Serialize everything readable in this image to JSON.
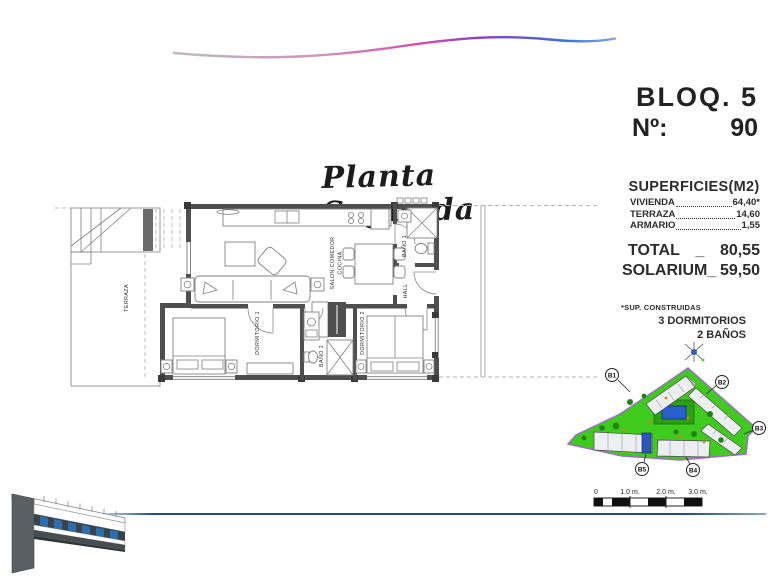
{
  "header": {
    "bloq_label": "BLOQ. 5",
    "num_label": "Nº:",
    "num_value": "90"
  },
  "title": "Planta Segunda",
  "floor_plan": {
    "rooms": {
      "terraza": "TERRAZA",
      "salon_line1": "SALON-COMEDOR",
      "salon_line2": "COCINA",
      "dormitorio1": "DORMITORIO 1",
      "dormitorio2": "DORMITORIO 2",
      "bano1": "BAÑO 1",
      "bano2": "BAÑO 2",
      "hall": "HALL"
    }
  },
  "superficies": {
    "title": "SUPERFICIES(M2)",
    "rows": [
      {
        "label": "VIVIENDA",
        "value": "64,40*"
      },
      {
        "label": "TERRAZA",
        "value": "14,60"
      },
      {
        "label": "ARMARIO",
        "value": "1,55"
      }
    ],
    "total_label": "TOTAL",
    "total_sep": "_",
    "total_value": "80,55",
    "solarium_label": "SOLARIUM_",
    "solarium_value": "59,50",
    "footnote": "*SUP. CONSTRUIDAS",
    "features": [
      "3 DORMITORIOS",
      "2 BAÑOS"
    ]
  },
  "site_plan": {
    "block_labels": [
      "B1",
      "B2",
      "B3",
      "B4",
      "B5"
    ]
  },
  "scale_bar": {
    "labels": [
      "0",
      "1.0 m.",
      "2.0 m.",
      "3.0 m."
    ]
  },
  "colors": {
    "accent_blue": "#1b4e8c",
    "site_green": "#3fcb1e",
    "pool_blue": "#2a5fd0",
    "highlight_blue": "#2d56b8",
    "wall_gray": "#4f4f4f"
  }
}
